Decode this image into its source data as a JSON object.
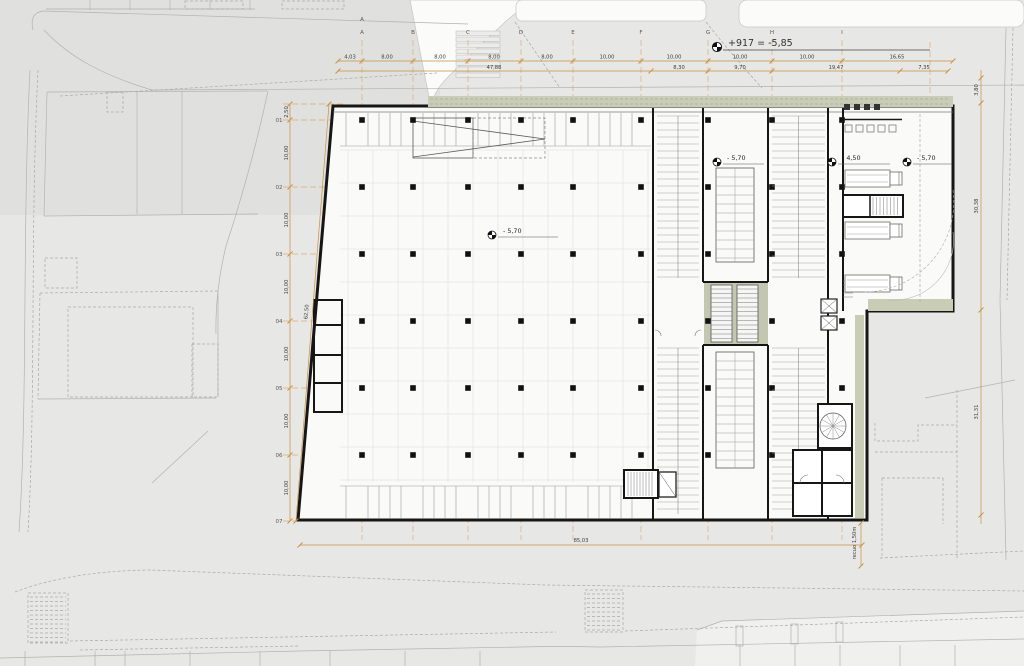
{
  "drawing": {
    "datum_annotation": "+917 = -5,85",
    "levels": {
      "center": "- 5,70",
      "right_a": "- 5,70",
      "right_b": "- 4,50",
      "right_c": "- 5,70"
    },
    "setback_label": "recuo 1,50m",
    "grid": {
      "letters": [
        "A",
        "B",
        "C",
        "D",
        "E",
        "F",
        "G",
        "H",
        "I"
      ],
      "letter_duplicate": "A",
      "numbers": [
        "01",
        "02",
        "03",
        "04",
        "05",
        "06",
        "07"
      ]
    },
    "dims": {
      "top_row1": [
        "4,03",
        "8,00",
        "8,00",
        "8,00",
        "8,00",
        "10,00",
        "10,00",
        "10,00",
        "10,00",
        "16,65"
      ],
      "top_row2": [
        "47,88",
        "8,30",
        "9,70",
        "19,47",
        "7,35"
      ],
      "left_chain": [
        "2,50",
        "10,00",
        "10,00",
        "10,00",
        "10,00",
        "10,00",
        "10,00"
      ],
      "left_total": "62,50",
      "right_chain": [
        "3,80",
        "30,38",
        "31,31"
      ],
      "bottom_total": "85,03"
    },
    "colors": {
      "accent_orange": "#c8913f",
      "grid_orange": "#dca76b",
      "green": "#c9cdb6",
      "core_green": "#c3c7b0",
      "wall": "#161616",
      "paper": "#e7e7e6",
      "interior": "#fafaf9"
    }
  }
}
